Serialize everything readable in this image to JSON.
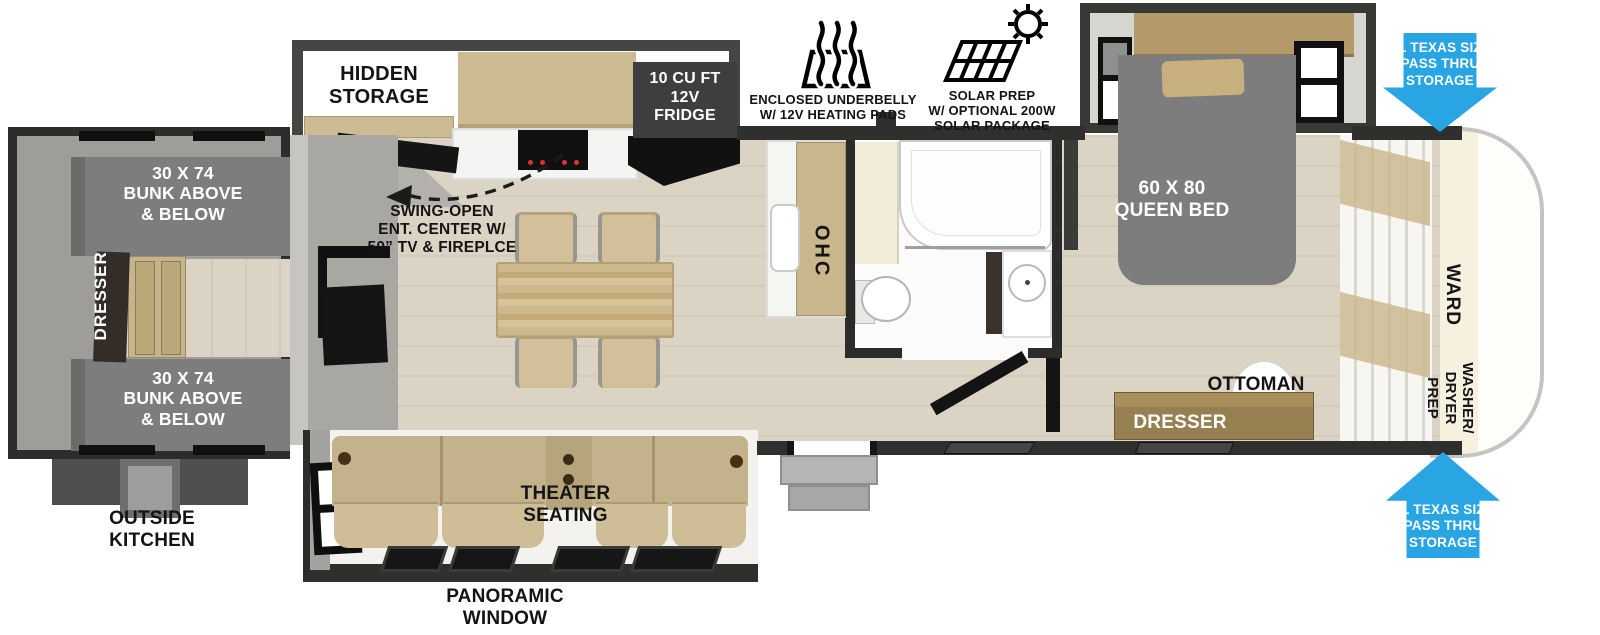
{
  "colors": {
    "arrow-blue": "#29a5e3",
    "wall-dark": "#2f2f2e",
    "floor-wood": "#dbd3c4",
    "cabinet-tan": "#cdbb93",
    "bed-gray": "#7d7d7d",
    "couch-tan": "#c3b28c",
    "dresser-brown": "#967f50",
    "cream": "#f6f1df"
  },
  "icons": {
    "underbelly": "heat-waves-icon",
    "solar": "solar-panel-sun-icon",
    "pass_thru_top": "down-arrow",
    "pass_thru_bottom": "up-arrow",
    "swing_open": "dashed-curve-arrow-icon"
  },
  "labels": {
    "hidden_storage": "HIDDEN\nSTORAGE",
    "fridge": "10 CU FT\n12V\nFRIDGE",
    "swing_open_ent_center": "SWING-OPEN\nENT. CENTER W/\n50” TV & FIREPLCE",
    "enclosed_underbelly": "ENCLOSED UNDERBELLY\nW/ 12V HEATING PADS",
    "solar_prep": "SOLAR PREP\nW/ OPTIONAL 200W\nSOLAR PACKAGE",
    "pass_thru_storage_top": "XL TEXAS SIZE\nPASS THRU\nSTORAGE",
    "pass_thru_storage_bottom": "XL TEXAS SIZE\nPASS THRU\nSTORAGE",
    "queen_bed": "60 X 80\nQUEEN BED",
    "overhead_cabinet": "OHC",
    "wardrobe": "WARD",
    "washer_dryer_prep": "WASHER/\nDRYER\nPREP",
    "ottoman": "OTTOMAN",
    "bedroom_dresser": "DRESSER",
    "bunk_top": "30 X 74\nBUNK ABOVE\n& BELOW",
    "bunk_bottom": "30 X 74\nBUNK ABOVE\n& BELOW",
    "bunk_dresser": "DRESSER",
    "outside_kitchen": "OUTSIDE\nKITCHEN",
    "theater_seating": "THEATER\nSEATING",
    "panoramic_window": "PANORAMIC\nWINDOW"
  }
}
